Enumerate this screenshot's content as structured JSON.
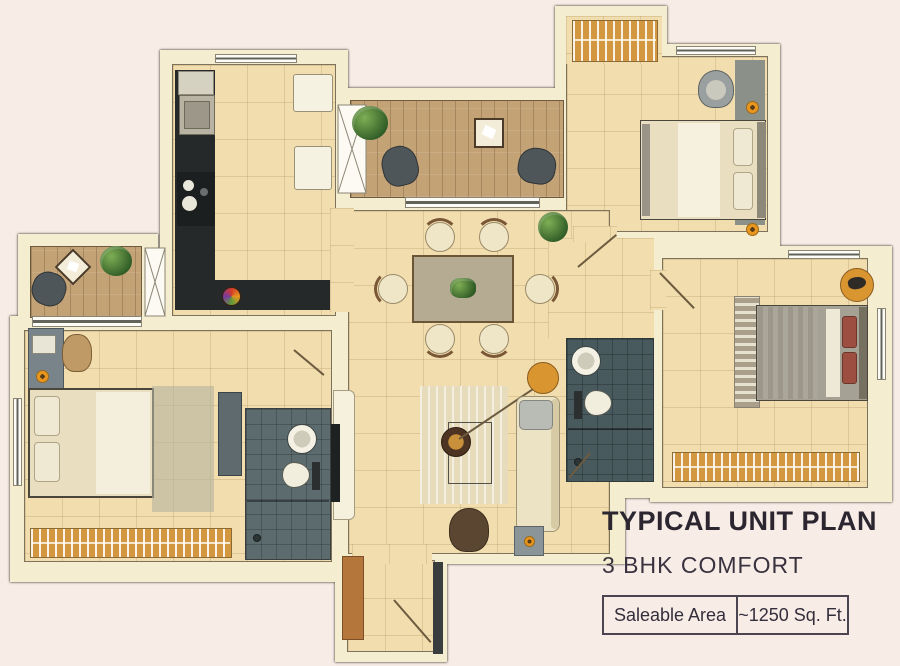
{
  "panel": {
    "title": "TYPICAL UNIT PLAN",
    "subtitle": "3 BHK COMFORT",
    "area_label": "Saleable Area",
    "area_value": "~1250 Sq. Ft."
  },
  "colors": {
    "background": "#f8ece7",
    "floor_tile": "#f1ddae",
    "wall_cream": "#f4edcf",
    "wood_deck": "#c3a376",
    "kitchen_counter": "#26292a",
    "bathroom_tile": "#5c6c6e",
    "bathroom_tile_dark": "#485a5e",
    "wardrobe_orange": "#d2973f",
    "accent_orange": "#e8961e",
    "text_dark": "#332e3b"
  }
}
